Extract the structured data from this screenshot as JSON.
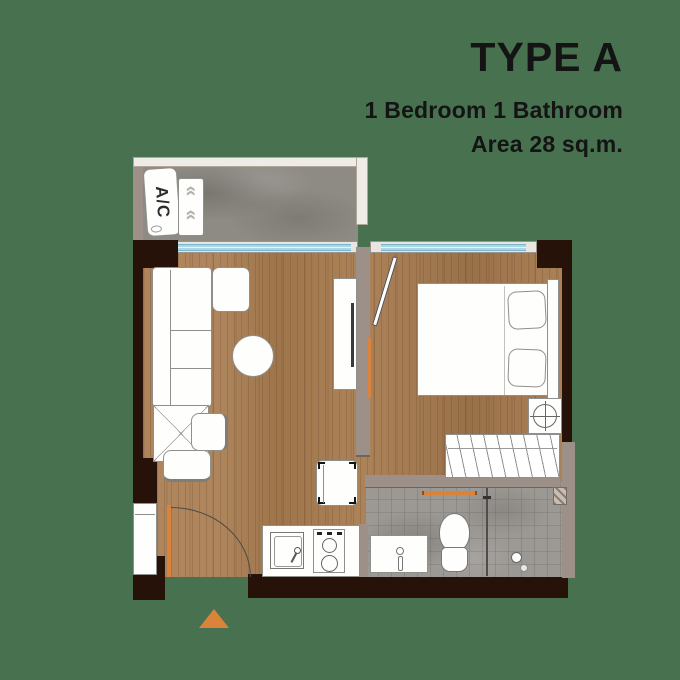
{
  "header": {
    "title": "TYPE A",
    "subtitle_line1": "1 Bedroom 1 Bathroom",
    "subtitle_line2": "Area 28 sq.m."
  },
  "plan": {
    "ac_label": "A/C",
    "rooms": [
      "Balcony",
      "Living Room",
      "Bedroom",
      "Bathroom",
      "Kitchen"
    ],
    "fixtures": [
      "A/C unit",
      "condenser",
      "sofa",
      "ottoman",
      "coffee table",
      "dining table",
      "chairs",
      "TV cabinet",
      "washing machine",
      "kitchen sink",
      "stove",
      "shoe cabinet",
      "entrance door",
      "bed",
      "pillows",
      "nightstand lamp",
      "wardrobe",
      "vanity sink",
      "toilet",
      "shower",
      "towel bar"
    ]
  },
  "colors": {
    "background": "#47714f",
    "wall_dark": "#261209",
    "wall_light": "#9d9088",
    "wood_floor": "#a87c50",
    "concrete_floor": "#8e8b85",
    "tile_floor": "#9c9995",
    "glass_blue": "#a9d7e8",
    "accent_orange": "#d9833b",
    "text": "#141414"
  }
}
